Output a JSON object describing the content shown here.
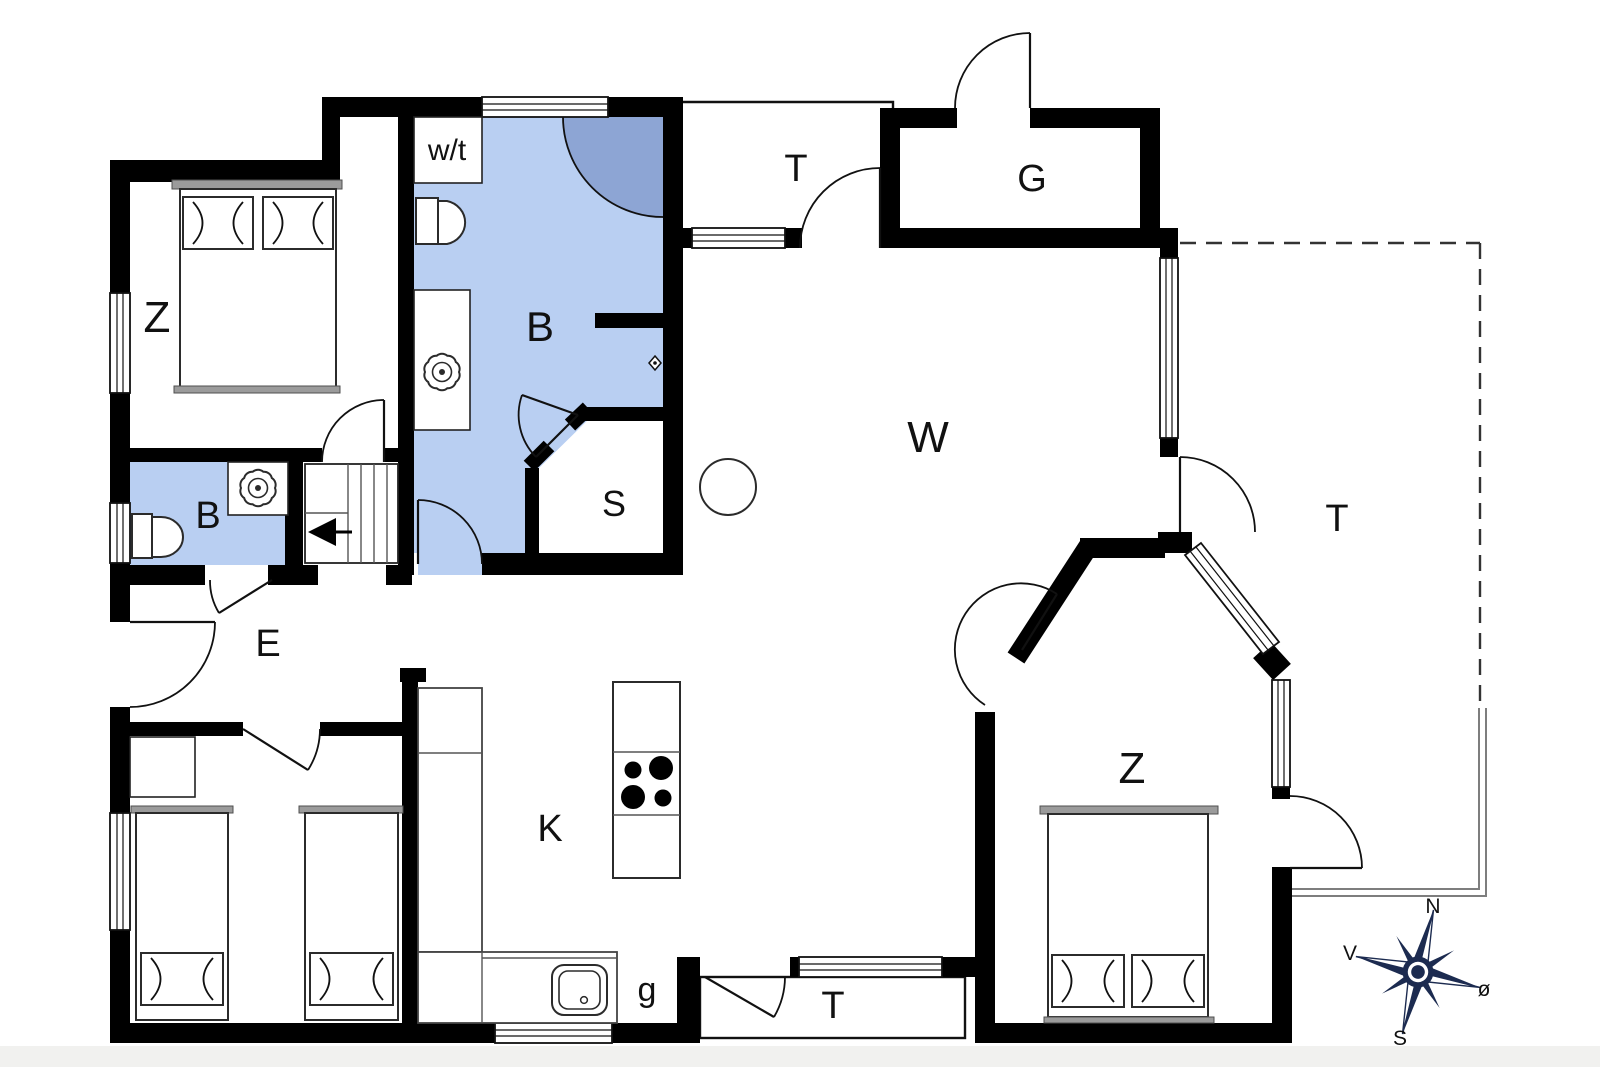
{
  "floorplan": {
    "type": "house-floor-plan",
    "rooms": [
      {
        "id": "bedroom-nw",
        "label": "Z"
      },
      {
        "id": "utility-closet",
        "label": "w/t"
      },
      {
        "id": "bathroom-main",
        "label": "B"
      },
      {
        "id": "terrace-north",
        "label": "T"
      },
      {
        "id": "outbuilding",
        "label": "G"
      },
      {
        "id": "living-room",
        "label": "W"
      },
      {
        "id": "bathroom-small",
        "label": "B"
      },
      {
        "id": "sauna",
        "label": "S"
      },
      {
        "id": "entrance-hall",
        "label": "E"
      },
      {
        "id": "terrace-east",
        "label": "T"
      },
      {
        "id": "kitchen",
        "label": "K"
      },
      {
        "id": "pantry",
        "label": "g"
      },
      {
        "id": "bedroom-se",
        "label": "Z"
      },
      {
        "id": "terrace-south",
        "label": "T"
      }
    ],
    "compass": {
      "north": "N",
      "west": "V",
      "east": "ø",
      "south": "S"
    },
    "colors": {
      "bath_floor": "#b9cff2",
      "shower": "#8da5d4",
      "wall": "#000000",
      "compass_navy": "#1c2b50"
    }
  }
}
